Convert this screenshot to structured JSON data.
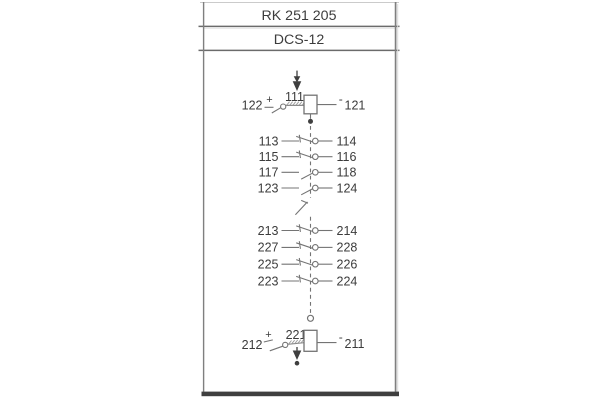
{
  "header": {
    "model": "RK 251 205",
    "series": "DCS-12"
  },
  "colors": {
    "line": "#747474",
    "text": "#3c3c3c",
    "border": "#7f7f7f",
    "rule": "#6b6b6b",
    "light_rule": "#cbcbcb",
    "bottom_bar": "#3f3f3f",
    "fill_dark": "#3f3f3f"
  },
  "top_coil": {
    "left_terminal": "122",
    "left_polarity": "+",
    "coil_label": "111",
    "right_polarity": "-",
    "right_terminal": "121"
  },
  "bottom_coil": {
    "left_terminal": "212",
    "left_polarity": "+",
    "coil_label": "221",
    "right_polarity": "-",
    "right_terminal": "211"
  },
  "contact_groups": [
    {
      "name": "group-1",
      "rows": [
        {
          "left": "113",
          "right": "114",
          "type": "nc"
        },
        {
          "left": "115",
          "right": "116",
          "type": "nc"
        },
        {
          "left": "117",
          "right": "118",
          "type": "no"
        },
        {
          "left": "123",
          "right": "124",
          "type": "no"
        }
      ]
    },
    {
      "name": "group-2",
      "rows": [
        {
          "left": "213",
          "right": "214",
          "type": "nc"
        },
        {
          "left": "227",
          "right": "228",
          "type": "nc"
        },
        {
          "left": "225",
          "right": "226",
          "type": "nc"
        },
        {
          "left": "223",
          "right": "224",
          "type": "nc"
        }
      ]
    }
  ]
}
